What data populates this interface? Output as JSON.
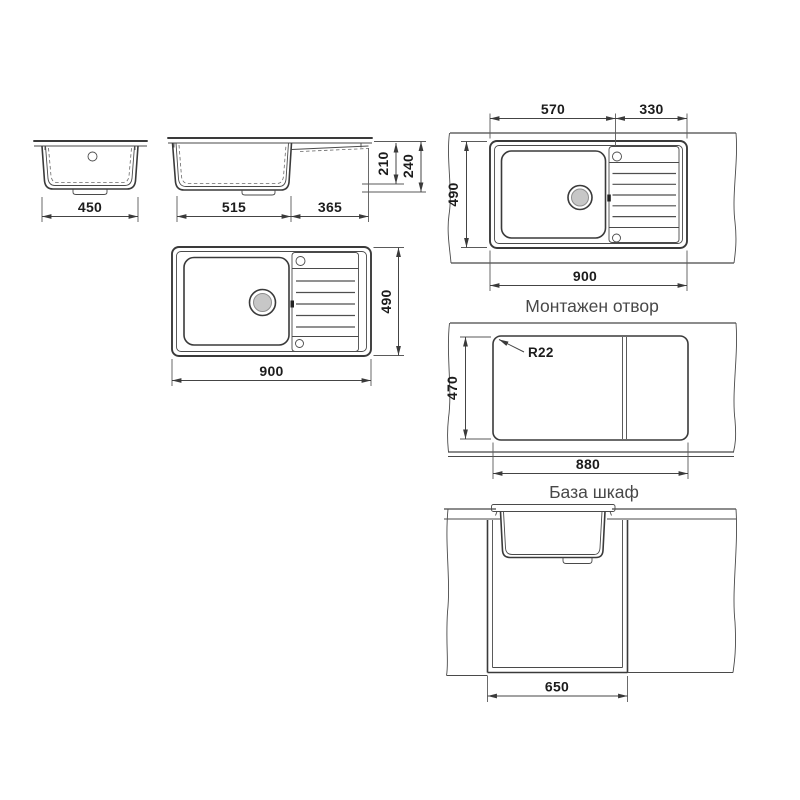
{
  "captions": {
    "mounting_hole": "Монтажен отвор",
    "base_cabinet": "База шкаф"
  },
  "dimensions": {
    "bowl_front_width": "450",
    "side_bowl_length": "515",
    "side_drainer_length": "365",
    "side_bowl_depth": "210",
    "side_total_height": "240",
    "plan_length": "900",
    "plan_width": "490",
    "mount_bowl_length": "570",
    "mount_drainer_length": "330",
    "mount_width": "490",
    "mount_length": "900",
    "cutout_corner_radius": "R22",
    "cutout_width": "470",
    "cutout_length": "880",
    "cabinet_width": "650"
  }
}
